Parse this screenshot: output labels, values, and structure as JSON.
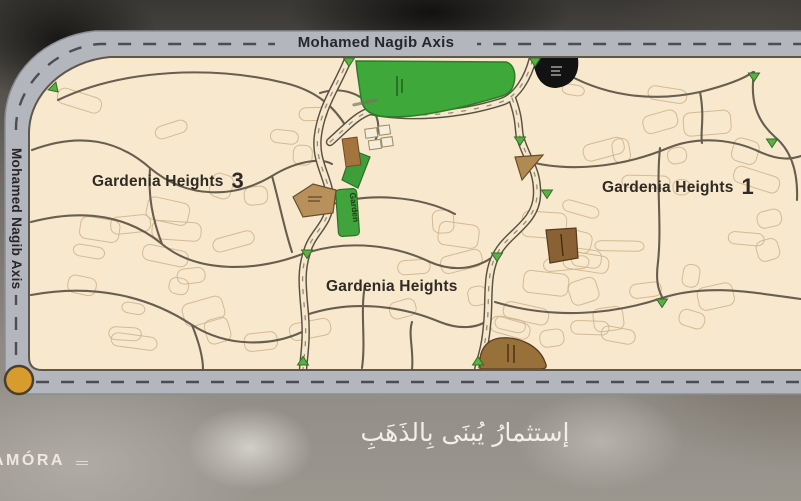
{
  "axis_roads": {
    "top_label": "Mohamed Nagib Axis",
    "left_label": "Mohamed Nagib Axis"
  },
  "district_labels": {
    "left": {
      "name": "Gardenia Heights",
      "number": "3"
    },
    "right": {
      "name": "Gardenia Heights",
      "number": "1"
    },
    "center": {
      "name": "Gardenia Heights",
      "number": ""
    }
  },
  "map_labels": {
    "garden_strip": "Garden"
  },
  "footer": {
    "brand": "AMÓRA",
    "tagline": "إستثمارُ يُبنَى بِالذَهَبِ"
  },
  "colors": {
    "map_background": "#f8e9ce",
    "axis_road_gray": "#b4b6bd",
    "green_area": "#3fa83b",
    "building_tan": "#b8905c",
    "building_brown": "#8a6134",
    "landmark_black": "#121212",
    "roundabout_orange": "#d89b2e"
  }
}
